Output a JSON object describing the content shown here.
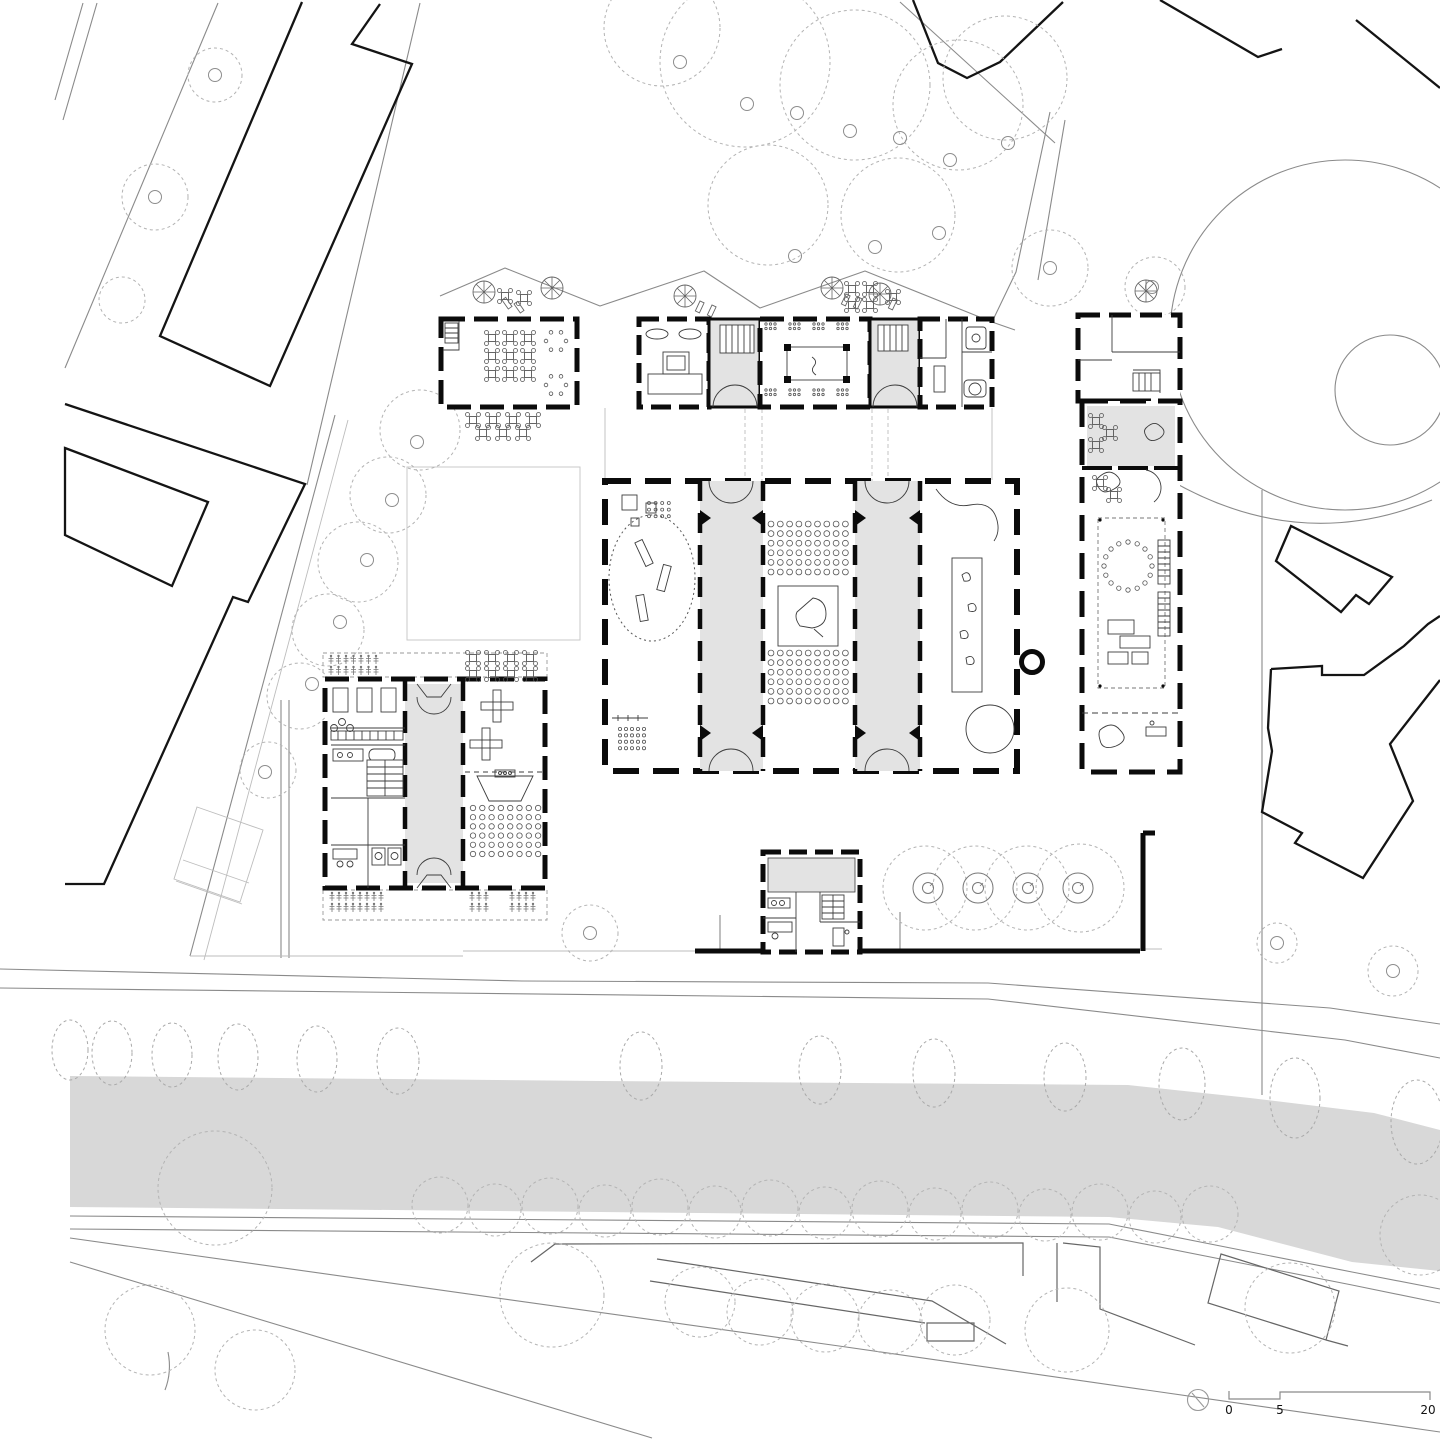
{
  "meta": {
    "drawing": "school campus site plan, ground floor"
  },
  "scale_bar": {
    "zero": "0",
    "five": "5",
    "twenty": "20"
  },
  "colors": {
    "paper": "#ffffff",
    "wall": "#0b0b0b",
    "room_gray": "#e3e3e3",
    "canal_gray": "#d8d8d8",
    "thin_line": "#8a8a8a",
    "tree_line": "#a9a9a9"
  },
  "icons": {
    "north_arrow": "north-arrow-icon",
    "parasol": "parasol-icon",
    "fountain": "fountain-icon"
  },
  "generated": {
    "street_trees": [
      {
        "cx": 70,
        "cy": 1050,
        "rx": 18,
        "ry": 30
      },
      {
        "cx": 112,
        "cy": 1053,
        "rx": 20,
        "ry": 32
      },
      {
        "cx": 172,
        "cy": 1055,
        "rx": 20,
        "ry": 32
      },
      {
        "cx": 238,
        "cy": 1057,
        "rx": 20,
        "ry": 33
      },
      {
        "cx": 317,
        "cy": 1059,
        "rx": 20,
        "ry": 33
      },
      {
        "cx": 398,
        "cy": 1061,
        "rx": 21,
        "ry": 33
      },
      {
        "cx": 641,
        "cy": 1066,
        "rx": 21,
        "ry": 34
      },
      {
        "cx": 820,
        "cy": 1070,
        "rx": 21,
        "ry": 34
      },
      {
        "cx": 934,
        "cy": 1073,
        "rx": 21,
        "ry": 34
      },
      {
        "cx": 1065,
        "cy": 1077,
        "rx": 21,
        "ry": 34
      },
      {
        "cx": 1182,
        "cy": 1084,
        "rx": 23,
        "ry": 36
      },
      {
        "cx": 1295,
        "cy": 1098,
        "rx": 25,
        "ry": 40
      },
      {
        "cx": 1417,
        "cy": 1122,
        "rx": 26,
        "ry": 42
      }
    ],
    "canopies": [
      {
        "cx": 215,
        "cy": 75,
        "r": 27
      },
      {
        "cx": 155,
        "cy": 197,
        "r": 33
      },
      {
        "cx": 122,
        "cy": 300,
        "r": 23
      },
      {
        "cx": 662,
        "cy": 28,
        "r": 58
      },
      {
        "cx": 745,
        "cy": 62,
        "r": 85
      },
      {
        "cx": 855,
        "cy": 85,
        "r": 75
      },
      {
        "cx": 958,
        "cy": 105,
        "r": 65
      },
      {
        "cx": 1005,
        "cy": 78,
        "r": 62
      },
      {
        "cx": 768,
        "cy": 205,
        "r": 60
      },
      {
        "cx": 898,
        "cy": 215,
        "r": 57
      },
      {
        "cx": 1050,
        "cy": 268,
        "r": 38
      },
      {
        "cx": 1155,
        "cy": 287,
        "r": 30
      },
      {
        "cx": 420,
        "cy": 430,
        "r": 40
      },
      {
        "cx": 388,
        "cy": 495,
        "r": 38
      },
      {
        "cx": 358,
        "cy": 562,
        "r": 40
      },
      {
        "cx": 328,
        "cy": 630,
        "r": 36
      },
      {
        "cx": 300,
        "cy": 696,
        "r": 33
      },
      {
        "cx": 268,
        "cy": 770,
        "r": 28
      },
      {
        "cx": 590,
        "cy": 933,
        "r": 28
      },
      {
        "cx": 925,
        "cy": 888,
        "r": 42
      },
      {
        "cx": 975,
        "cy": 888,
        "r": 42
      },
      {
        "cx": 1027,
        "cy": 888,
        "r": 42
      },
      {
        "cx": 1080,
        "cy": 888,
        "r": 44
      },
      {
        "cx": 1277,
        "cy": 943,
        "r": 20
      },
      {
        "cx": 1393,
        "cy": 971,
        "r": 25
      },
      {
        "cx": 215,
        "cy": 1188,
        "r": 57
      },
      {
        "cx": 552,
        "cy": 1295,
        "r": 52
      },
      {
        "cx": 440,
        "cy": 1205,
        "r": 28
      },
      {
        "cx": 495,
        "cy": 1210,
        "r": 26
      },
      {
        "cx": 550,
        "cy": 1206,
        "r": 28
      },
      {
        "cx": 605,
        "cy": 1211,
        "r": 26
      },
      {
        "cx": 660,
        "cy": 1207,
        "r": 28
      },
      {
        "cx": 715,
        "cy": 1212,
        "r": 26
      },
      {
        "cx": 770,
        "cy": 1208,
        "r": 28
      },
      {
        "cx": 825,
        "cy": 1213,
        "r": 26
      },
      {
        "cx": 880,
        "cy": 1209,
        "r": 28
      },
      {
        "cx": 935,
        "cy": 1214,
        "r": 26
      },
      {
        "cx": 990,
        "cy": 1210,
        "r": 28
      },
      {
        "cx": 1045,
        "cy": 1215,
        "r": 26
      },
      {
        "cx": 1100,
        "cy": 1212,
        "r": 28
      },
      {
        "cx": 1155,
        "cy": 1217,
        "r": 26
      },
      {
        "cx": 1210,
        "cy": 1214,
        "r": 28
      },
      {
        "cx": 700,
        "cy": 1302,
        "r": 35
      },
      {
        "cx": 760,
        "cy": 1312,
        "r": 33
      },
      {
        "cx": 825,
        "cy": 1318,
        "r": 34
      },
      {
        "cx": 890,
        "cy": 1322,
        "r": 32
      },
      {
        "cx": 955,
        "cy": 1320,
        "r": 35
      },
      {
        "cx": 1067,
        "cy": 1330,
        "r": 42
      },
      {
        "cx": 1290,
        "cy": 1308,
        "r": 45
      },
      {
        "cx": 1420,
        "cy": 1235,
        "r": 40
      },
      {
        "cx": 150,
        "cy": 1330,
        "r": 45
      },
      {
        "cx": 255,
        "cy": 1370,
        "r": 40
      }
    ],
    "trunks": [
      {
        "cx": 747,
        "cy": 104
      },
      {
        "cx": 797,
        "cy": 113
      },
      {
        "cx": 850,
        "cy": 131
      },
      {
        "cx": 900,
        "cy": 138
      },
      {
        "cx": 950,
        "cy": 160
      },
      {
        "cx": 1008,
        "cy": 143
      },
      {
        "cx": 939,
        "cy": 233
      },
      {
        "cx": 875,
        "cy": 247
      },
      {
        "cx": 795,
        "cy": 256
      },
      {
        "cx": 680,
        "cy": 62
      },
      {
        "cx": 417,
        "cy": 442
      },
      {
        "cx": 392,
        "cy": 500
      },
      {
        "cx": 367,
        "cy": 560
      },
      {
        "cx": 340,
        "cy": 622
      },
      {
        "cx": 312,
        "cy": 684
      },
      {
        "cx": 265,
        "cy": 772
      },
      {
        "cx": 590,
        "cy": 933
      },
      {
        "cx": 215,
        "cy": 75
      },
      {
        "cx": 155,
        "cy": 197
      },
      {
        "cx": 1050,
        "cy": 268
      },
      {
        "cx": 1152,
        "cy": 287
      },
      {
        "cx": 1277,
        "cy": 943
      },
      {
        "cx": 1393,
        "cy": 971
      }
    ],
    "parasols": [
      {
        "cx": 484,
        "cy": 292
      },
      {
        "cx": 552,
        "cy": 288
      },
      {
        "cx": 685,
        "cy": 296
      },
      {
        "cx": 832,
        "cy": 288
      },
      {
        "cx": 880,
        "cy": 294
      },
      {
        "cx": 1146,
        "cy": 291
      }
    ],
    "benches": [
      {
        "x": 502,
        "y": 300,
        "a": -35
      },
      {
        "x": 514,
        "y": 304,
        "a": -35
      },
      {
        "x": 700,
        "y": 301,
        "a": 25
      },
      {
        "x": 712,
        "y": 305,
        "a": 25
      },
      {
        "x": 846,
        "y": 294,
        "a": 25
      },
      {
        "x": 858,
        "y": 297,
        "a": 25
      },
      {
        "x": 893,
        "y": 298,
        "a": 25
      }
    ],
    "fountains": [
      {
        "cx": 928,
        "cy": 888
      },
      {
        "cx": 978,
        "cy": 888
      },
      {
        "cx": 1028,
        "cy": 888
      },
      {
        "cx": 1078,
        "cy": 888
      }
    ],
    "tables": [
      {
        "x": 492,
        "y": 338
      },
      {
        "x": 510,
        "y": 338
      },
      {
        "x": 528,
        "y": 338
      },
      {
        "x": 492,
        "y": 356
      },
      {
        "x": 510,
        "y": 356
      },
      {
        "x": 528,
        "y": 356
      },
      {
        "x": 492,
        "y": 374
      },
      {
        "x": 510,
        "y": 374
      },
      {
        "x": 528,
        "y": 374
      },
      {
        "x": 473,
        "y": 420
      },
      {
        "x": 493,
        "y": 420
      },
      {
        "x": 513,
        "y": 420
      },
      {
        "x": 533,
        "y": 420
      },
      {
        "x": 483,
        "y": 433
      },
      {
        "x": 503,
        "y": 433
      },
      {
        "x": 523,
        "y": 433
      },
      {
        "x": 473,
        "y": 658
      },
      {
        "x": 492,
        "y": 658
      },
      {
        "x": 511,
        "y": 658
      },
      {
        "x": 530,
        "y": 658
      },
      {
        "x": 473,
        "y": 674
      },
      {
        "x": 492,
        "y": 674
      },
      {
        "x": 511,
        "y": 674
      },
      {
        "x": 530,
        "y": 674
      },
      {
        "x": 505,
        "y": 296
      },
      {
        "x": 524,
        "y": 298
      },
      {
        "x": 852,
        "y": 289
      },
      {
        "x": 870,
        "y": 289
      },
      {
        "x": 852,
        "y": 305
      },
      {
        "x": 870,
        "y": 305
      },
      {
        "x": 893,
        "y": 297
      },
      {
        "x": 1096,
        "y": 421
      },
      {
        "x": 1110,
        "y": 433
      },
      {
        "x": 1096,
        "y": 445
      },
      {
        "x": 1100,
        "y": 483
      },
      {
        "x": 1114,
        "y": 495
      }
    ],
    "plant_rows": [
      {
        "x": 331,
        "y": 656,
        "count": 7,
        "dx": 7.5,
        "rows": 2,
        "dy": 11
      },
      {
        "x": 332,
        "y": 893,
        "count": 8,
        "dx": 7,
        "rows": 2,
        "dy": 11
      },
      {
        "x": 472,
        "y": 893,
        "count": 3,
        "dx": 7,
        "rows": 2,
        "dy": 11
      },
      {
        "x": 512,
        "y": 893,
        "count": 4,
        "dx": 7,
        "rows": 2,
        "dy": 11
      }
    ],
    "seat_grids": [
      {
        "x": 771,
        "y": 524,
        "cols": 9,
        "rows": 6,
        "dx": 9.3,
        "dy": 9.6,
        "r": 2.9
      },
      {
        "x": 771,
        "y": 653,
        "cols": 9,
        "rows": 6,
        "dx": 9.3,
        "dy": 9.6,
        "r": 2.9
      },
      {
        "x": 473,
        "y": 808,
        "cols": 8,
        "rows": 6,
        "dx": 9.3,
        "dy": 9.2,
        "r": 2.7
      },
      {
        "x": 620,
        "y": 729,
        "cols": 5,
        "rows": 4,
        "dx": 6,
        "dy": 6.4,
        "r": 1.6
      },
      {
        "x": 649,
        "y": 503,
        "cols": 4,
        "rows": 3,
        "dx": 6.6,
        "dy": 6.6,
        "r": 1.5
      },
      {
        "x": 766,
        "y": 324,
        "cols": 3,
        "rows": 2,
        "dx": 4.5,
        "dy": 4.5,
        "r": 1.2
      },
      {
        "x": 790,
        "y": 324,
        "cols": 3,
        "rows": 2,
        "dx": 4.5,
        "dy": 4.5,
        "r": 1.2
      },
      {
        "x": 814,
        "y": 324,
        "cols": 3,
        "rows": 2,
        "dx": 4.5,
        "dy": 4.5,
        "r": 1.2
      },
      {
        "x": 838,
        "y": 324,
        "cols": 3,
        "rows": 2,
        "dx": 4.5,
        "dy": 4.5,
        "r": 1.2
      },
      {
        "x": 766,
        "y": 390,
        "cols": 3,
        "rows": 2,
        "dx": 4.5,
        "dy": 4.5,
        "r": 1.2
      },
      {
        "x": 790,
        "y": 390,
        "cols": 3,
        "rows": 2,
        "dx": 4.5,
        "dy": 4.5,
        "r": 1.2
      },
      {
        "x": 814,
        "y": 390,
        "cols": 3,
        "rows": 2,
        "dx": 4.5,
        "dy": 4.5,
        "r": 1.2
      },
      {
        "x": 838,
        "y": 390,
        "cols": 3,
        "rows": 2,
        "dx": 4.5,
        "dy": 4.5,
        "r": 1.2
      }
    ],
    "rings": [
      {
        "cx": 556,
        "cy": 341,
        "r": 10,
        "n": 6,
        "dot": 1.8
      },
      {
        "cx": 556,
        "cy": 385,
        "r": 10,
        "n": 6,
        "dot": 1.8
      },
      {
        "cx": 1128,
        "cy": 566,
        "r": 24,
        "n": 16,
        "dot": 2.2
      }
    ]
  }
}
